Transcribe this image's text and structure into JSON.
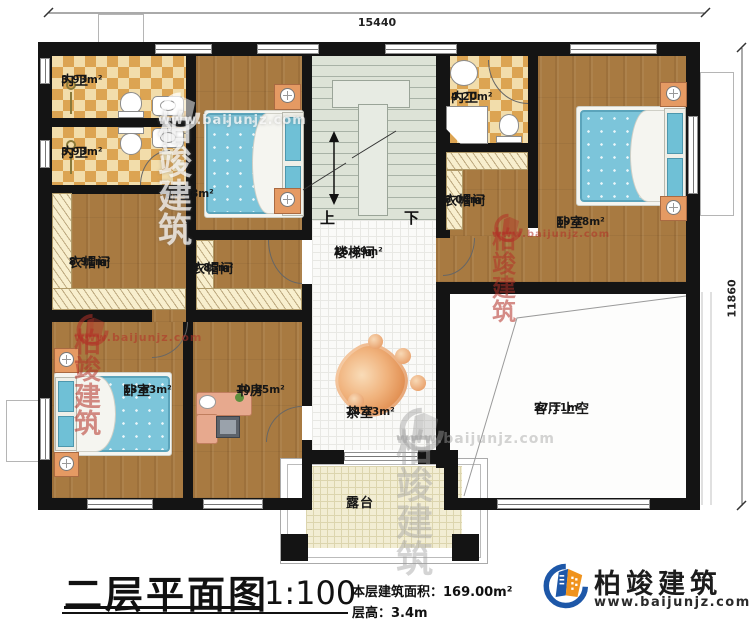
{
  "dimensions": {
    "top": "15440",
    "right": "11860"
  },
  "stairs": {
    "up": "上",
    "down": "下"
  },
  "rooms": [
    {
      "name": "内卫",
      "area": "3.93m²"
    },
    {
      "name": "内卫",
      "area": "3.93m²"
    },
    {
      "name": "卧室",
      "area": "13.08m²"
    },
    {
      "name": "衣帽间",
      "area": "8.91m²"
    },
    {
      "name": "衣帽间",
      "area": "4.85m²"
    },
    {
      "name": "楼梯间",
      "area": "16.69m²"
    },
    {
      "name": "内卫",
      "area": "4.20m²"
    },
    {
      "name": "衣帽间",
      "area": "6.04m²"
    },
    {
      "name": "卧室",
      "area": "19.18m²"
    },
    {
      "name": "卧室",
      "area": "13.63m²"
    },
    {
      "name": "书房",
      "area": "10.85m²"
    },
    {
      "name": "茶室",
      "area": "14.13m²"
    },
    {
      "name": "客厅上空",
      "area": "27.11m²"
    },
    {
      "name": "露台",
      "area": ""
    }
  ],
  "titleblock": {
    "title": "二层平面图",
    "scale": "1:100",
    "area_line": "本层建筑面积：169.00m²",
    "height_line": "层高：3.4m"
  },
  "brand": {
    "name": "柏竣建筑",
    "url": "www.baijunjz.com"
  },
  "colors": {
    "wall": "#141414",
    "wood": "#a87a41",
    "tile": "#dca452",
    "bed": "#7cc5da",
    "brand_blue": "#1d57a8",
    "brand_orange": "#f0931d",
    "watermark_red": "#b23026"
  }
}
